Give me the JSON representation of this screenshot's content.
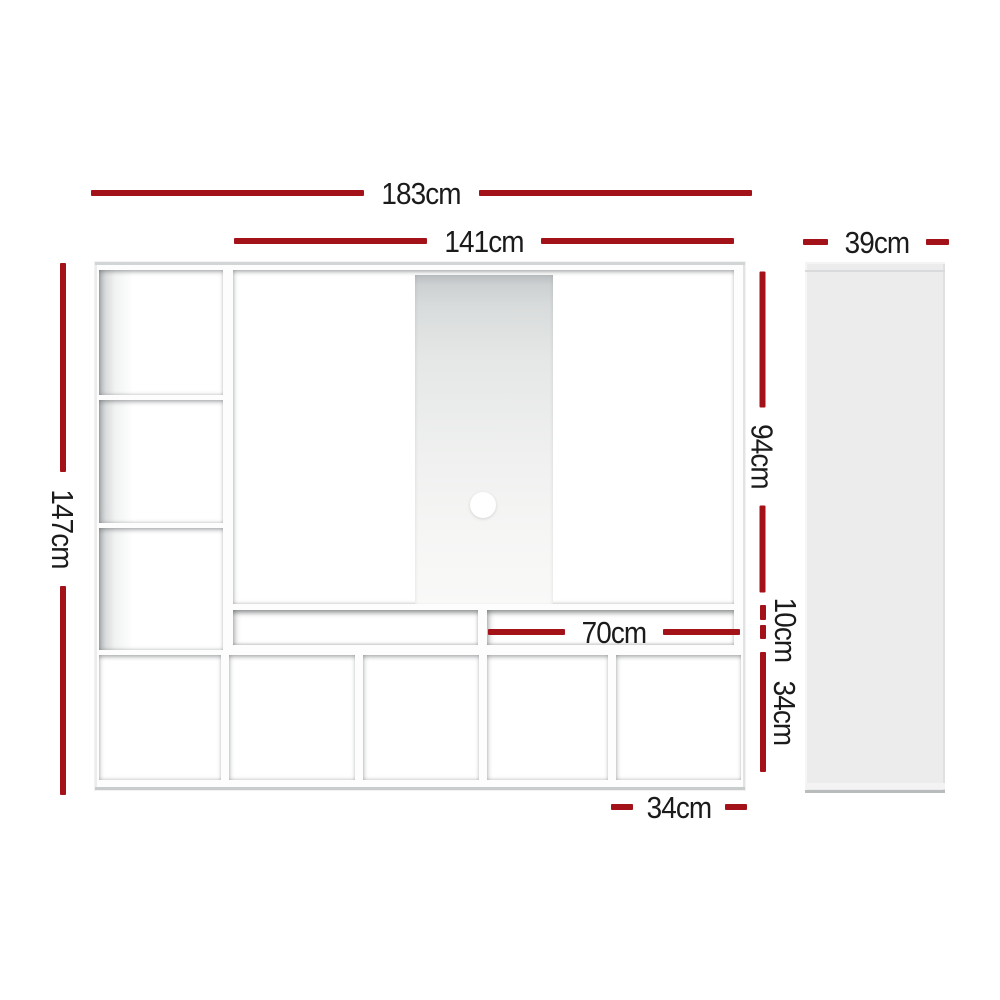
{
  "colors": {
    "dimension_red": "#a31218",
    "label_color": "#1b1b1b",
    "side_panel_gray": "#ececec"
  },
  "front_view": {
    "total_width_label": "183cm",
    "tv_opening_width_label": "141cm",
    "total_height_label": "147cm",
    "tv_opening_height_label": "94cm",
    "media_slot_height_label": "10cm",
    "cube_height_label": "34cm",
    "media_slot_width_label": "70cm",
    "cube_width_label": "34cm"
  },
  "side_view": {
    "depth_label": "39cm"
  }
}
